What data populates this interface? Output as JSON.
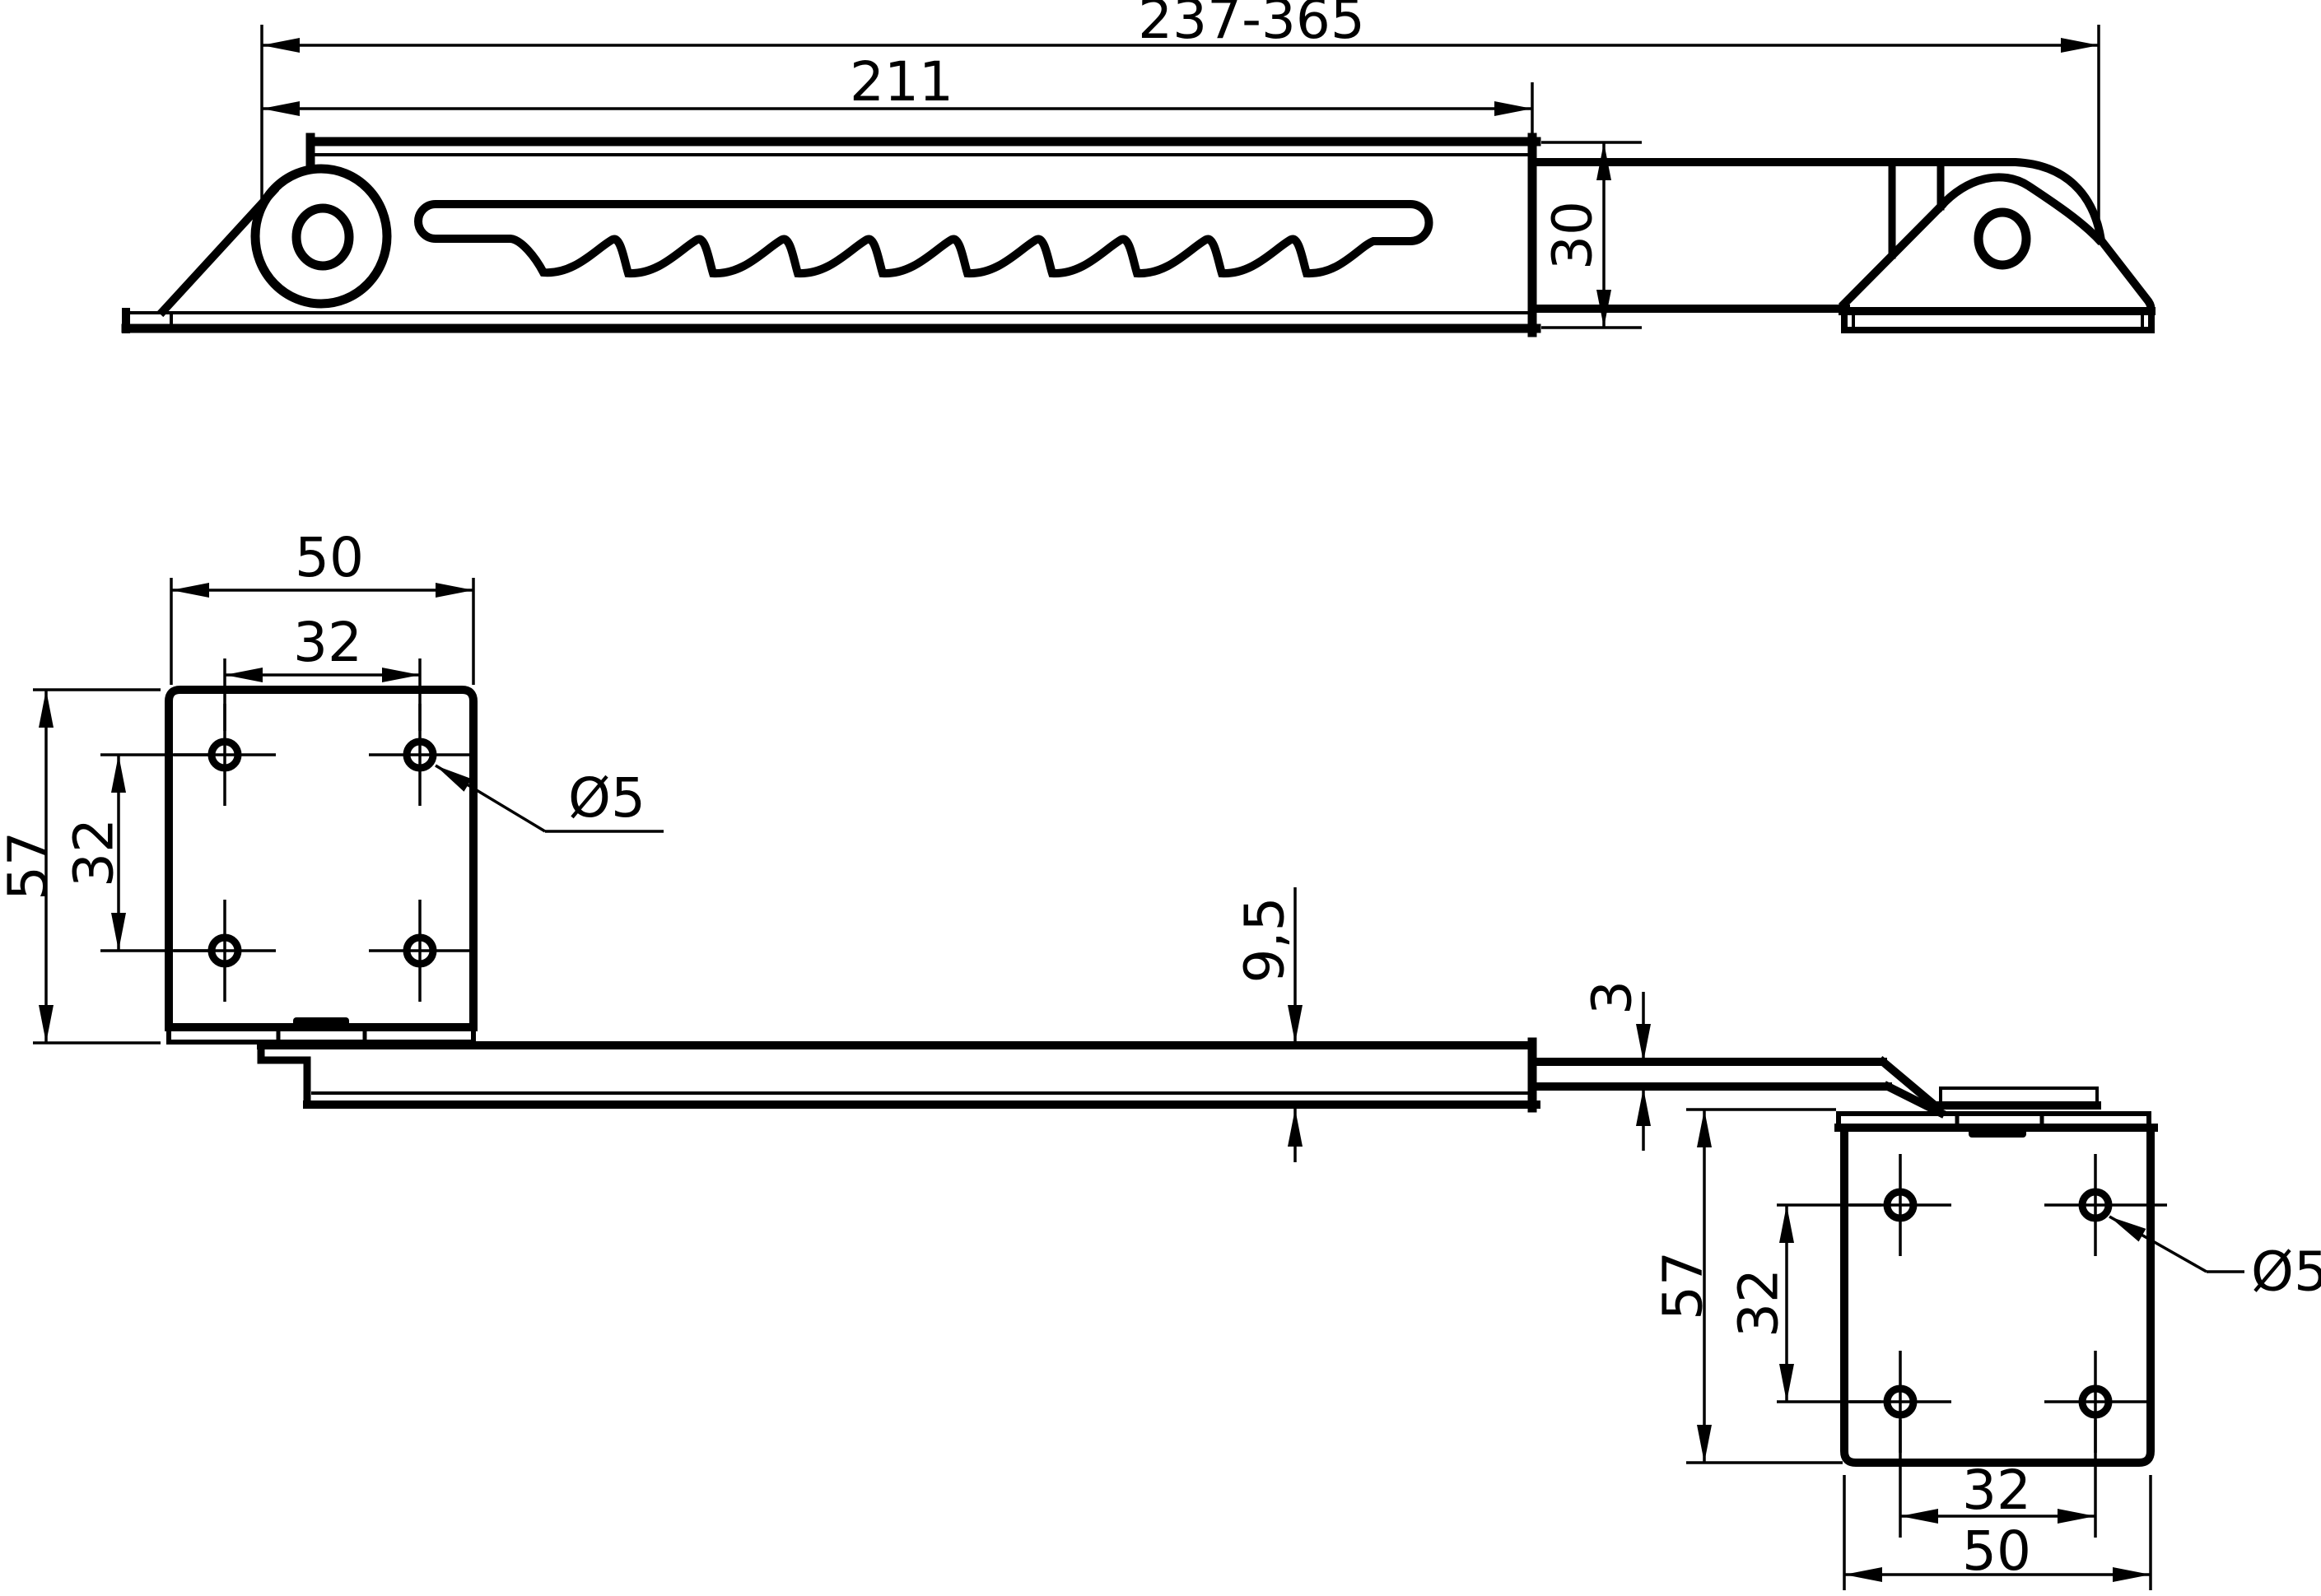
{
  "drawing": {
    "type": "technical-drawing",
    "subject": "friction-stay-with-mounting-plates",
    "colors": {
      "line": "#000000",
      "background": "#ffffff"
    }
  },
  "dims": {
    "top": {
      "overall": "237-365",
      "rail": "211",
      "width": "30"
    },
    "plate_left": {
      "width": "50",
      "holes_h": "32",
      "height": "57",
      "holes_v": "32",
      "hole_dia": "Ø5"
    },
    "side": {
      "rail_thickness": "9,5",
      "strap_thickness": "3"
    },
    "plate_right": {
      "height": "57",
      "holes_v": "32",
      "hole_dia": "Ø5",
      "holes_h": "32",
      "width": "50"
    }
  }
}
